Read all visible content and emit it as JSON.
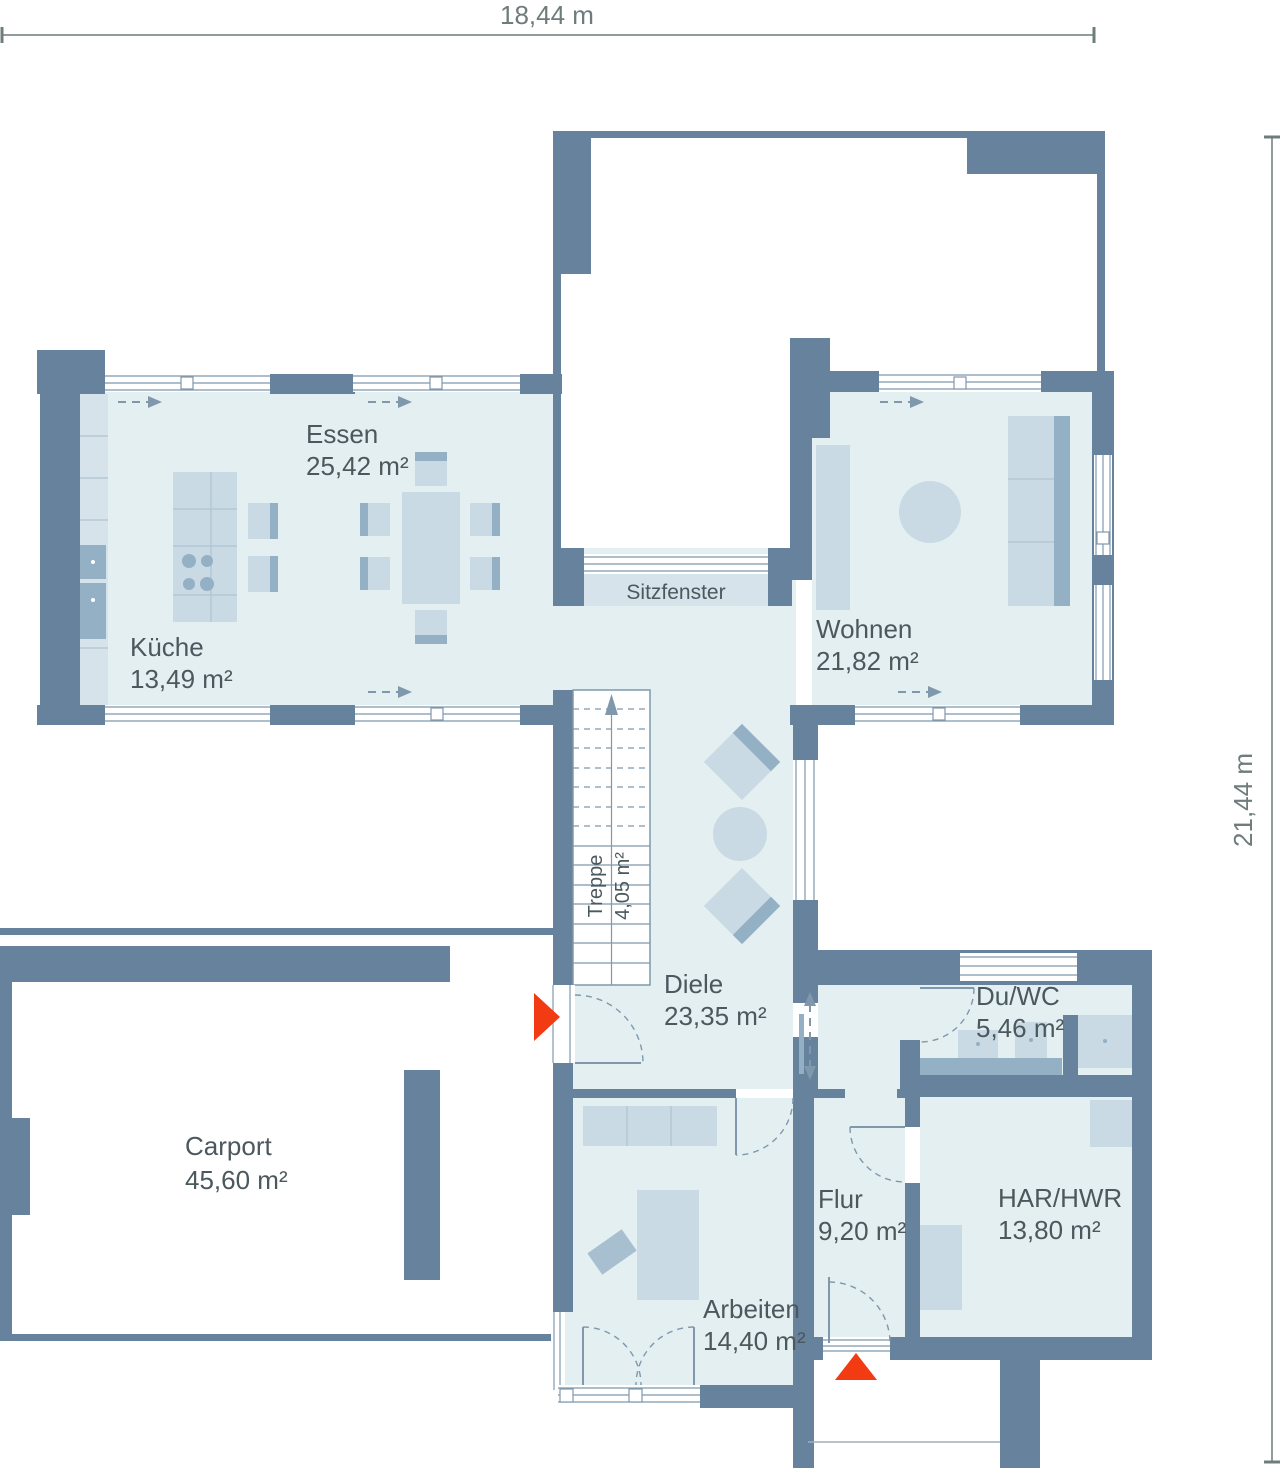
{
  "dimensions": {
    "width_label": "18,44 m",
    "height_label": "21,44 m"
  },
  "rooms": {
    "essen": {
      "name": "Essen",
      "area": "25,42 m²"
    },
    "kueche": {
      "name": "Küche",
      "area": "13,49 m²"
    },
    "wohnen": {
      "name": "Wohnen",
      "area": "21,82 m²"
    },
    "sitzfenster": {
      "name": "Sitzfenster"
    },
    "treppe": {
      "name": "Treppe",
      "area": "4,05 m²"
    },
    "diele": {
      "name": "Diele",
      "area": "23,35 m²"
    },
    "duwc": {
      "name": "Du/WC",
      "area": "5,46 m²"
    },
    "carport": {
      "name": "Carport",
      "area": "45,60 m²"
    },
    "flur": {
      "name": "Flur",
      "area": "9,20 m²"
    },
    "harhwr": {
      "name": "HAR/HWR",
      "area": "13,80 m²"
    },
    "arbeiten": {
      "name": "Arbeiten",
      "area": "14,40 m²"
    }
  },
  "colors": {
    "wall": "#66829c",
    "room_fill": "#e4eff1",
    "furniture": "#c9dae5",
    "furniture_dark": "#94b0c4",
    "bench": "#d6e3ea",
    "line": "#7f98ac",
    "text": "#4b585d",
    "dimension": "#6f7c7c",
    "accent_red": "#f23a13",
    "background": "#ffffff"
  }
}
